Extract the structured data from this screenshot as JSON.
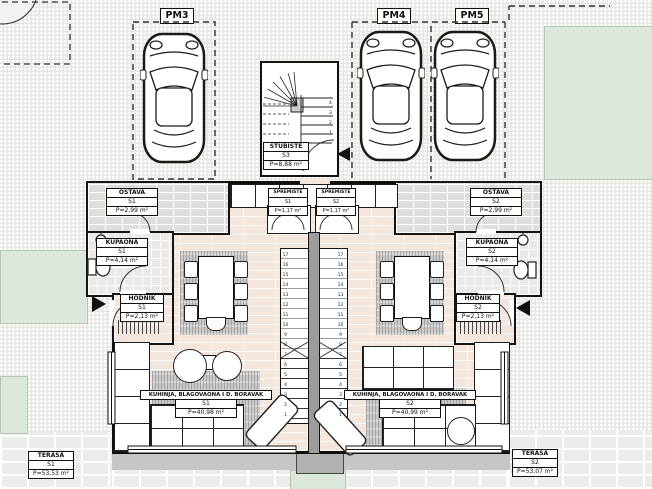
{
  "parking": {
    "pm3": {
      "label": "PM3"
    },
    "pm4": {
      "label": "PM4"
    },
    "pm5": {
      "label": "PM5"
    }
  },
  "rooms": {
    "stubiste": {
      "name": "STUBIŠTE",
      "unit": "S3",
      "area": "P=8,88 m²"
    },
    "ostava_s1": {
      "name": "OSTAVA",
      "unit": "S1",
      "area": "P=2,99 m²"
    },
    "ostava_s2": {
      "name": "OSTAVA",
      "unit": "S2",
      "area": "P=2,99 m²"
    },
    "spremiste_s1": {
      "name": "SPREMIŠTE",
      "unit": "S1",
      "area": "P=1,17 m²"
    },
    "spremiste_s2": {
      "name": "SPREMIŠTE",
      "unit": "S2",
      "area": "P=1,17 m²"
    },
    "kupaona_s1": {
      "name": "KUPAONA",
      "unit": "S1",
      "area": "P=4,14 m²"
    },
    "kupaona_s2": {
      "name": "KUPAONA",
      "unit": "S2",
      "area": "P=4,14 m²"
    },
    "hodnik_s1": {
      "name": "HODNIK",
      "unit": "S1",
      "area": "P=2,13 m²"
    },
    "hodnik_s2": {
      "name": "HODNIK",
      "unit": "S2",
      "area": "P=2,13 m²"
    },
    "living_s1": {
      "name": "KUHINJA, BLAGOVAONA I D. BORAVAK",
      "unit": "S1",
      "area": "P=40,98 m²"
    },
    "living_s2": {
      "name": "KUHINJA, BLAGOVAONA I D. BORAVAK",
      "unit": "S2",
      "area": "P=40,99 m²"
    },
    "terasa_s1": {
      "name": "TERASA",
      "unit": "S1",
      "area": "P=53,53 m²"
    },
    "terasa_s2": {
      "name": "TERASA",
      "unit": "S2",
      "area": "P=53,07 m²"
    }
  },
  "stairs": {
    "steps": [
      "1",
      "2",
      "3",
      "4",
      "5",
      "6",
      "7",
      "8",
      "9",
      "10",
      "11",
      "12",
      "13",
      "14",
      "15",
      "16",
      "17"
    ],
    "top_steps": [
      "4",
      "3",
      "2",
      "1"
    ]
  },
  "colors": {
    "paving": "#e6e6e3",
    "floor": "#f3e6dd",
    "green": "#dbe7da",
    "rug": "#c8c8c8",
    "terrace_tile": "#ececea",
    "wall": "#111111"
  }
}
